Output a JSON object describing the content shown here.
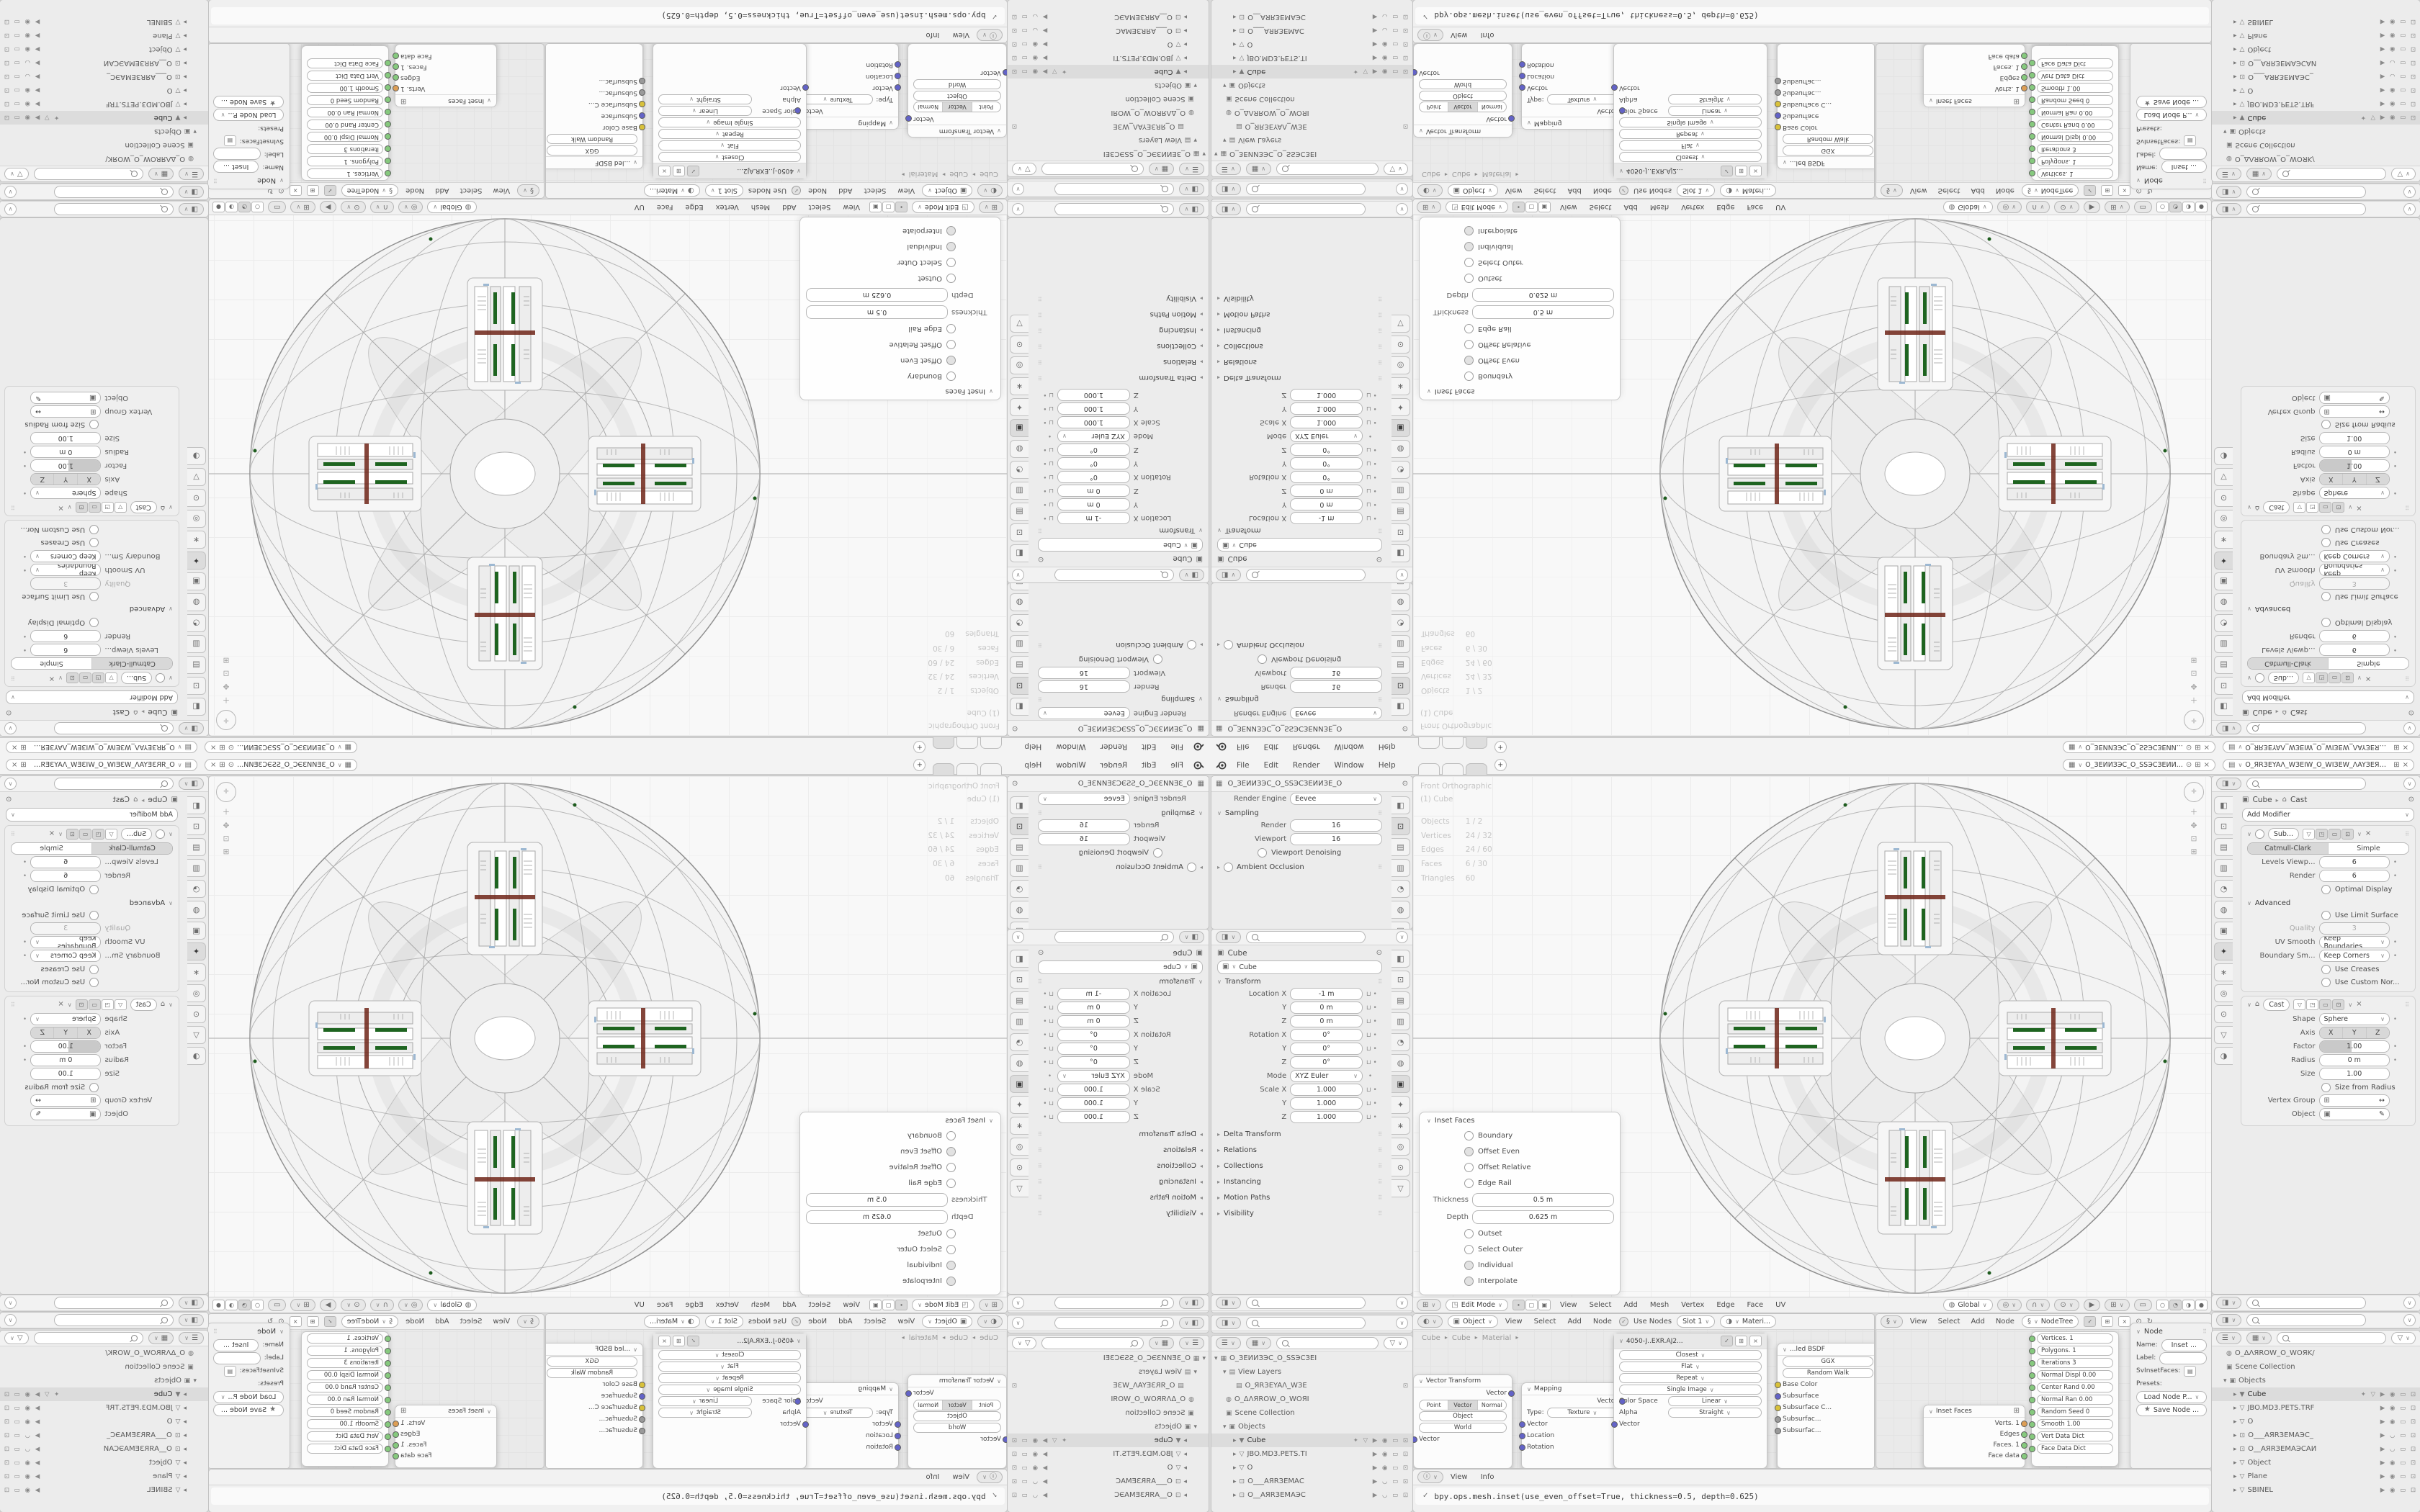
{
  "colors": {
    "green_bar": "#1e6420",
    "dark_red": "#6e2418",
    "socket_green": "#86c97e",
    "socket_orange": "#dd9e55",
    "socket_blue": "#6363c7",
    "socket_yellow": "#d8c13b",
    "grid": "#ececec",
    "selection": "#dcdcdc"
  },
  "icons": {
    "chevron_down": "∨",
    "chevron_right": "▸",
    "arrow_down": "▾",
    "arrow_right": "▸",
    "lock": "⊔",
    "dot": "•",
    "close": "×",
    "check": "✓",
    "pin": "⊙",
    "funnel": "▽",
    "plus": "+",
    "grid": "⊞",
    "camera": "⊡",
    "eye": "◉",
    "screen": "▭",
    "select": "▶",
    "mesh": "▽",
    "world": "◍",
    "collection": "▣",
    "scene": "▦",
    "image": "▤",
    "wrench": "✦",
    "refresh": "↻",
    "star": "★",
    "drag": "⠿",
    "object": "▣",
    "editmode": "◳",
    "tool": "◧",
    "toggle": "◨"
  },
  "topbar": {
    "menus": [
      "File",
      "Edit",
      "Render",
      "Window",
      "Help"
    ],
    "tabs": [
      {
        "on": false
      },
      {
        "on": false
      },
      {
        "on": true
      }
    ],
    "new_tab": "+",
    "scene": {
      "name": "O_ЗЕИИЗЭС_О_ЅЅЭСЗЕИИ..."
    },
    "view_layer": {
      "name": "O_ЯRЗЕYAΛ_WЗЕIW_O_WIЗЕW_ΛAYЗЕЯR_O"
    }
  },
  "props_tabs": {
    "a": [
      {
        "g": "◧",
        "on": false
      },
      {
        "g": "⊡",
        "on": true
      },
      {
        "g": "▤",
        "on": false
      },
      {
        "g": "▥",
        "on": false
      },
      {
        "g": "◔",
        "on": false
      },
      {
        "g": "◍",
        "on": false
      },
      {
        "g": "▣",
        "on": false
      }
    ],
    "b": [
      {
        "g": "◧",
        "on": false
      },
      {
        "g": "⊡",
        "on": false
      },
      {
        "g": "▤",
        "on": false
      },
      {
        "g": "▥",
        "on": false
      },
      {
        "g": "◔",
        "on": false
      },
      {
        "g": "◍",
        "on": false
      },
      {
        "g": "▣",
        "on": true
      },
      {
        "g": "✦",
        "on": false
      },
      {
        "g": "∗",
        "on": false
      },
      {
        "g": "◎",
        "on": false
      },
      {
        "g": "⊙",
        "on": false
      },
      {
        "g": "▽",
        "on": false
      }
    ],
    "r": [
      {
        "g": "◧",
        "on": false
      },
      {
        "g": "⊡",
        "on": false
      },
      {
        "g": "▤",
        "on": false
      },
      {
        "g": "▥",
        "on": false
      },
      {
        "g": "◔",
        "on": false
      },
      {
        "g": "◍",
        "on": false
      },
      {
        "g": "▣",
        "on": false
      },
      {
        "g": "✦",
        "on": true
      },
      {
        "g": "∗",
        "on": false
      },
      {
        "g": "◎",
        "on": false
      },
      {
        "g": "⊙",
        "on": false
      },
      {
        "g": "▽",
        "on": false
      },
      {
        "g": "◑",
        "on": false
      }
    ]
  },
  "props_render": {
    "breadcrumb": "O_ЗЕИИЗЭС_O_ЅЅЭСЗЕИИЗЕ_O",
    "engine_label": "Render Engine",
    "engine": "Eevee",
    "sampling": "Sampling",
    "render_label": "Render",
    "render": "16",
    "viewport_label": "Viewport",
    "viewport": "16",
    "denoise": "Viewport Denoising",
    "ao": "Ambient Occlusion"
  },
  "props_object": {
    "breadcrumb": "Cube",
    "name": "Cube",
    "transform": "Transform",
    "rows1": [
      {
        "l": "Location X",
        "v": "-1 m"
      },
      {
        "l": "Y",
        "v": "0 m"
      },
      {
        "l": "Z",
        "v": "0 m"
      },
      {
        "l": "Rotation X",
        "v": "0°"
      },
      {
        "l": "Y",
        "v": "0°"
      },
      {
        "l": "Z",
        "v": "0°"
      }
    ],
    "mode_label": "Mode",
    "mode": "XYZ Euler",
    "rows2": [
      {
        "l": "Scale X",
        "v": "1.000"
      },
      {
        "l": "Y",
        "v": "1.000"
      },
      {
        "l": "Z",
        "v": "1.000"
      }
    ],
    "panels": [
      {
        "t": "Delta Transform"
      },
      {
        "t": "Relations"
      },
      {
        "t": "Collections"
      },
      {
        "t": "Instancing"
      },
      {
        "t": "Motion Paths"
      },
      {
        "t": "Visibility"
      }
    ]
  },
  "outliner_left": {
    "rows": [
      {
        "pad": "4px",
        "a": "▾",
        "ic": "▦",
        "label": "O_ЗЕИИЗЭС_О_ЅЅЭСЗЕI",
        "ri": "",
        "sel": false
      },
      {
        "pad": "16px",
        "a": "▾",
        "ic": "▤",
        "label": "View Layers",
        "ri": "",
        "sel": false
      },
      {
        "pad": "30px",
        "a": "",
        "ic": "▤",
        "label": "O_ЯRЗЕYAΛ_WЗЕ",
        "ri": "⊡",
        "sel": false
      },
      {
        "pad": "16px",
        "a": "",
        "ic": "◍",
        "label": "O_ΔΛЯROW_O_WOЯI",
        "ri": "",
        "sel": false
      },
      {
        "pad": "16px",
        "a": "",
        "ic": "▣",
        "label": "Scene Collection",
        "ri": "",
        "sel": false
      },
      {
        "pad": "16px",
        "a": "▾",
        "ic": "▣",
        "label": "Objects",
        "ri": "",
        "sel": false
      },
      {
        "pad": "30px",
        "a": "▸",
        "ic": "▼",
        "label": "Cube",
        "ri": "✦ ▽ ▶ ◉ ▭ ⊡",
        "sel": true
      },
      {
        "pad": "30px",
        "a": "▸",
        "ic": "▽",
        "label": "JBO.MD3.PETS.TI",
        "ri": "▶ ◉ ▭ ⊡",
        "sel": false
      },
      {
        "pad": "30px",
        "a": "▸",
        "ic": "▽",
        "label": "O",
        "ri": "▶ ◉ ▭ ⊡",
        "sel": false
      },
      {
        "pad": "30px",
        "a": "▸",
        "ic": "⊡",
        "label": "O___AЯRЗЕМАС",
        "ri": "▶ ◡ ▭ ⊡",
        "sel": false
      },
      {
        "pad": "30px",
        "a": "▸",
        "ic": "⊡",
        "label": "O__AЯRЗЕМАЭС",
        "ri": "▶ ◡ ▭ ⊡",
        "sel": false
      }
    ]
  },
  "outliner_right": {
    "rows": [
      {
        "pad": "16px",
        "a": "",
        "ic": "◍",
        "label": "O_ΔΛЯROW_O_WOЯK/",
        "ri": "",
        "sel": false
      },
      {
        "pad": "16px",
        "a": "",
        "ic": "▣",
        "label": "Scene Collection",
        "ri": "",
        "sel": false
      },
      {
        "pad": "16px",
        "a": "▾",
        "ic": "▣",
        "label": "Objects",
        "ri": "",
        "sel": false
      },
      {
        "pad": "30px",
        "a": "▸",
        "ic": "▼",
        "label": "Cube",
        "ri": "✦ ▽ ▶ ◉ ▭ ⊡",
        "sel": true
      },
      {
        "pad": "30px",
        "a": "▸",
        "ic": "▽",
        "label": "JBO.MD3.PETS.TRF",
        "ri": "▶ ◉ ▭ ⊡",
        "sel": false
      },
      {
        "pad": "30px",
        "a": "▸",
        "ic": "▽",
        "label": "O",
        "ri": "▶ ◉ ▭ ⊡",
        "sel": false
      },
      {
        "pad": "30px",
        "a": "▸",
        "ic": "⊡",
        "label": "O___AЯRЗЕМАЭС_",
        "ri": "▶ ◡ ▭ ⊡",
        "sel": false
      },
      {
        "pad": "30px",
        "a": "▸",
        "ic": "⊡",
        "label": "O__AЯRЗЕМАЭСAИ",
        "ri": "▶ ◡ ▭ ⊡",
        "sel": false
      },
      {
        "pad": "30px",
        "a": "▸",
        "ic": "▽",
        "label": "Object",
        "ri": "▶ ◉ ▭ ⊡",
        "sel": false
      },
      {
        "pad": "30px",
        "a": "▸",
        "ic": "▽",
        "label": "Plane",
        "ri": "▶ ◉ ▭ ⊡",
        "sel": false
      },
      {
        "pad": "30px",
        "a": "▸",
        "ic": "▽",
        "label": "SBINEL",
        "ri": "▶ ◉ ▭ ⊡",
        "sel": false
      }
    ]
  },
  "viewport": {
    "overlay_line1": "Front Orthographic",
    "overlay_line2": "(1) Cube",
    "stats": [
      {
        "k": "Objects",
        "v": "1 / 2"
      },
      {
        "k": "Vertices",
        "v": "24 / 32"
      },
      {
        "k": "Edges",
        "v": "24 / 60"
      },
      {
        "k": "Faces",
        "v": "6 / 30"
      },
      {
        "k": "Triangles",
        "v": "60"
      }
    ],
    "mode": "Edit Mode",
    "menus": [
      "View",
      "Select",
      "Add",
      "Mesh",
      "Vertex",
      "Edge",
      "Face",
      "UV"
    ],
    "orientation": "Global"
  },
  "inset_panel": {
    "title": "Inset Faces",
    "checks1": [
      {
        "label": "Boundary",
        "on": false
      },
      {
        "label": "Offset Even",
        "on": true
      },
      {
        "label": "Offset Relative",
        "on": false
      },
      {
        "label": "Edge Rail",
        "on": false
      }
    ],
    "thickness_label": "Thickness",
    "thickness": "0.5 m",
    "depth_label": "Depth",
    "depth": "0.625 m",
    "checks2": [
      {
        "label": "Outset",
        "on": false
      },
      {
        "label": "Select Outer",
        "on": false
      },
      {
        "label": "Individual",
        "on": true
      },
      {
        "label": "Interpolate",
        "on": true
      }
    ]
  },
  "props_modifier": {
    "crumb_obj": "Cube",
    "crumb_mod": "Cast",
    "add": "Add Modifier",
    "subsurf": {
      "name": "Sub...",
      "catmull": "Catmull-Clark",
      "simple": "Simple",
      "levels_label": "Levels Viewp...",
      "levels": "6",
      "render_label": "Render",
      "render": "6",
      "optimal": "Optimal Display",
      "advanced": "Advanced",
      "use_limit": "Use Limit Surface",
      "quality_label": "Quality",
      "quality": "3",
      "uv_label": "UV Smooth",
      "uv": "Keep Boundaries",
      "bnd_label": "Boundary Sm...",
      "bnd": "Keep Corners",
      "creases": "Use Creases",
      "custom": "Use Custom Nor..."
    },
    "cast": {
      "name": "Cast",
      "shape_label": "Shape",
      "shape": "Sphere",
      "axis_label": "Axis",
      "axis_x": "X",
      "axis_y": "Y",
      "axis_z": "Z",
      "factor_label": "Factor",
      "factor": "1.00",
      "radius_label": "Radius",
      "radius": "0 m",
      "size_label": "Size",
      "size": "1.00",
      "size_from": "Size from Radius",
      "vgroup_label": "Vertex Group",
      "object_label": "Object"
    }
  },
  "shader": {
    "type": "Object",
    "menus": [
      "View",
      "Select",
      "Add",
      "Node"
    ],
    "use_nodes": "Use Nodes",
    "slot": "Slot 1",
    "material": "Materi...",
    "path": [
      {
        "t": "Cube"
      },
      {
        "t": "Cube"
      },
      {
        "t": "Material"
      }
    ],
    "vt": {
      "title": "Vector Transform",
      "out": "Vector",
      "seg": [
        {
          "t": "Point",
          "on": false
        },
        {
          "t": "Vector",
          "on": true
        },
        {
          "t": "Normal",
          "on": false
        }
      ],
      "f1": "Object",
      "f2": "World",
      "in": "Vector"
    },
    "mapping": {
      "title": "Mapping",
      "out": "Vector",
      "type_label": "Type:",
      "type": "Texture",
      "ins": [
        {
          "t": "Vector"
        },
        {
          "t": "Location"
        },
        {
          "t": "Rotation"
        }
      ],
      "x": "X",
      "xv": "0°"
    },
    "image": {
      "title": "4050-J..EXR.AJ2...",
      "fields": [
        {
          "t": "Closest"
        },
        {
          "t": "Flat"
        },
        {
          "t": "Repeat"
        },
        {
          "t": "Single Image"
        }
      ],
      "cs_label": "Color Space",
      "cs": "Linear",
      "alpha_label": "Alpha",
      "alpha": "Straight",
      "in": "Vector"
    },
    "principled": {
      "title": "...led BSDF",
      "f1": "GGX",
      "f2": "Random Walk",
      "rows": [
        {
          "c": "#d8c13b",
          "t": "Base Color"
        },
        {
          "c": "#6363c7",
          "t": "Subsurface"
        },
        {
          "c": "#d8c13b",
          "t": "Subsurface C..."
        },
        {
          "c": "#9a9a9a",
          "t": "Subsurfac..."
        },
        {
          "c": "#9a9a9a",
          "t": "Subsurfac..."
        }
      ]
    }
  },
  "sverchok": {
    "menus": [
      "View",
      "Select",
      "Add",
      "Node"
    ],
    "tree": "NodeTree",
    "inset_node": {
      "title": "Inset Faces",
      "outs": [
        {
          "t": "Verts. 1",
          "c": "#dd9e55"
        },
        {
          "t": "Edges",
          "c": "#86c97e"
        },
        {
          "t": "Faces. 1",
          "c": "#86c97e"
        },
        {
          "t": "Face data",
          "c": "#86c97e"
        }
      ]
    },
    "input_node": {
      "rows": [
        {
          "t": "Vertices. 1",
          "pill": false
        },
        {
          "t": "Polygons. 1",
          "pill": false
        },
        {
          "t": "Iterations          3",
          "pill": true
        },
        {
          "t": "Normal Displ  0.00",
          "pill": true
        },
        {
          "t": "Center Rand  0.00",
          "pill": true
        },
        {
          "t": "Normal Ran  0.00",
          "pill": true
        },
        {
          "t": "Random Seed  0",
          "pill": true
        },
        {
          "t": "Smooth  1.00",
          "pill": true
        },
        {
          "t": "Vert Data Dict",
          "pill": false
        },
        {
          "t": "Face Data Dict",
          "pill": false
        }
      ]
    },
    "npanel": {
      "title": "Node",
      "name_label": "Name:",
      "name": "Inset ...",
      "label_label": "Label:",
      "sv": "SvInsetFaces:",
      "presets": "Presets:",
      "load": "Load Node P...",
      "save": "Save Node ..."
    }
  },
  "info": {
    "menus": [
      "View",
      "Info"
    ],
    "line": "bpy.ops.mesh.inset(use_even_offset=True, thickness=0.5, depth=0.625)"
  }
}
